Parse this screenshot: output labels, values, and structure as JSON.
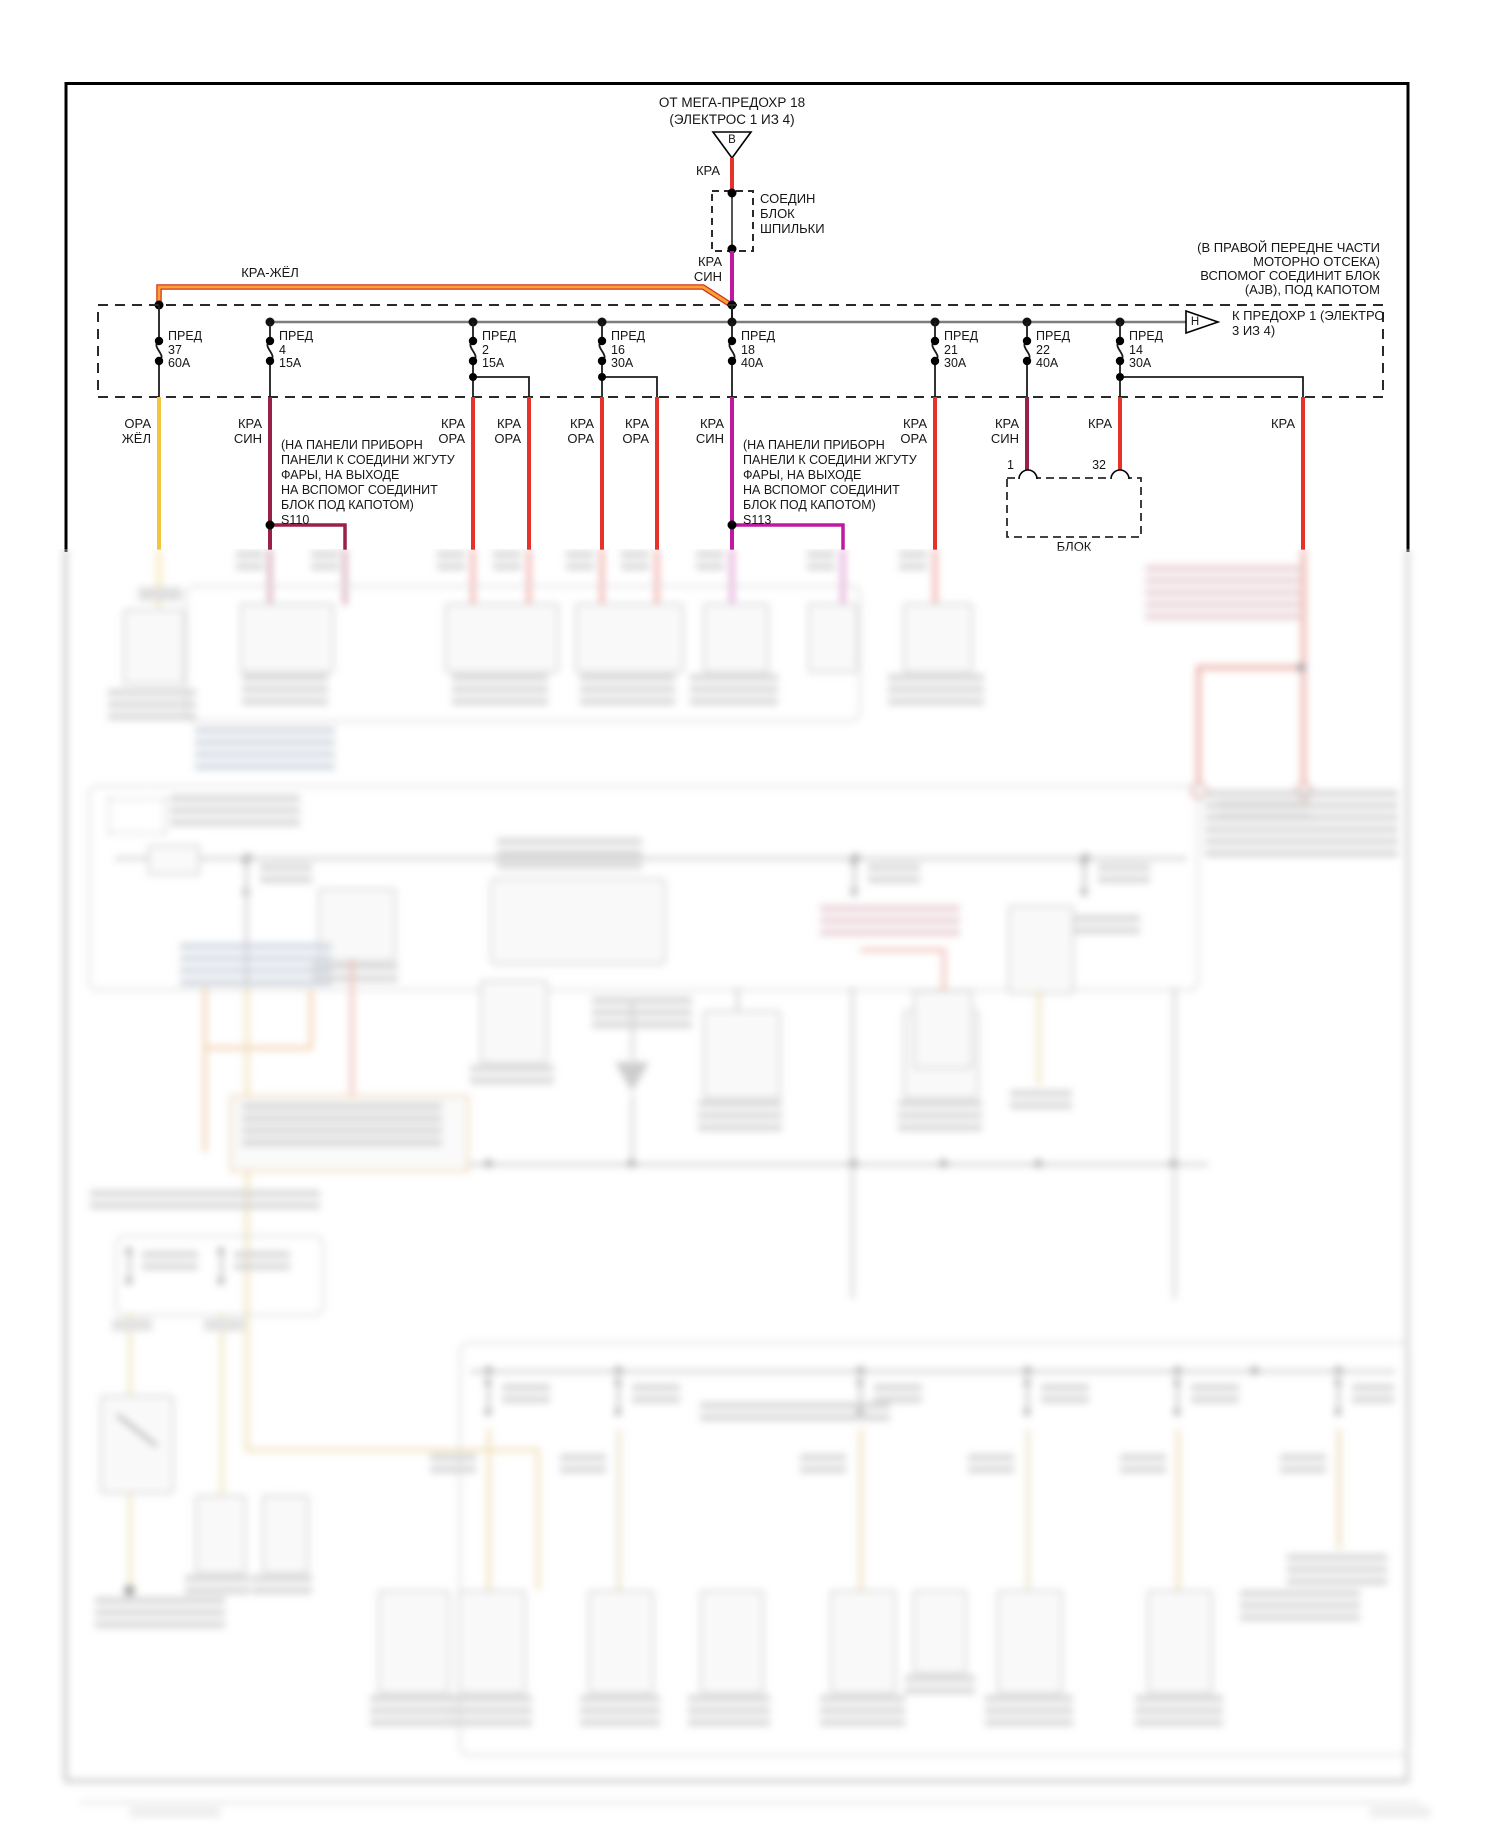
{
  "palette": {
    "red_wire": "#e63329",
    "yellow_wire": "#f2c63c",
    "maroon_wire": "#97214a",
    "magenta_wire": "#c018a0",
    "orange_wire": "#f09a25",
    "orange_wire_edge": "#d93025",
    "bus_gray": "#7d7d7d",
    "ink": "#161616"
  },
  "header": {
    "source_line1": "ОТ МЕГА-ПРЕДОХР 18",
    "source_line2": "(ЭЛЕКТРОС 1 ИЗ 4)",
    "source_connector_letter": "B",
    "source_wire_label": "КРА",
    "splice_block_line1": "СОЕДИН",
    "splice_block_line2": "БЛОК",
    "splice_block_line3": "ШПИЛЬКИ",
    "feed_wire_line1": "КРА",
    "feed_wire_line2": "СИН",
    "jumper_wire_label": "КРА-ЖЁЛ",
    "location_note_line1": "(В ПРАВОЙ ПЕРЕДНЕ ЧАСТИ",
    "location_note_line2": "МОТОРНО ОТСЕКА)",
    "location_note_line3": "ВСПОМОГ СОЕДИНИТ БЛОК",
    "location_note_line4": "(AJB), ПОД КАПОТОМ"
  },
  "fuse_box": {
    "fuses": [
      {
        "label": "ПРЕД",
        "number": "37",
        "amps": "60A"
      },
      {
        "label": "ПРЕД",
        "number": "4",
        "amps": "15A"
      },
      {
        "label": "ПРЕД",
        "number": "2",
        "amps": "15A"
      },
      {
        "label": "ПРЕД",
        "number": "16",
        "amps": "30A"
      },
      {
        "label": "ПРЕД",
        "number": "18",
        "amps": "40A"
      },
      {
        "label": "ПРЕД",
        "number": "21",
        "amps": "30A"
      },
      {
        "label": "ПРЕД",
        "number": "22",
        "amps": "40A"
      },
      {
        "label": "ПРЕД",
        "number": "14",
        "amps": "30A"
      }
    ],
    "exit_connector_letter": "H",
    "exit_label_line1": "К ПРЕДОХР 1 (ЭЛЕКТРО",
    "exit_label_line2": "3 ИЗ 4)"
  },
  "wire_labels": [
    {
      "line1": "ОРА",
      "line2": "ЖЁЛ"
    },
    {
      "line1": "КРА",
      "line2": "СИН"
    },
    {
      "line1": "КРА",
      "line2": "ОРА"
    },
    {
      "line1": "КРА",
      "line2": "ОРА"
    },
    {
      "line1": "КРА",
      "line2": "ОРА"
    },
    {
      "line1": "КРА",
      "line2": "ОРА"
    },
    {
      "line1": "КРА",
      "line2": "СИН"
    },
    {
      "line1": "КРА",
      "line2": "ОРА"
    },
    {
      "line1": "КРА",
      "line2": "СИН"
    },
    {
      "line1": "КРА",
      "line2": ""
    },
    {
      "line1": "КРА",
      "line2": ""
    }
  ],
  "splice_note_s110": {
    "line1": "(НА ПАНЕЛИ ПРИБОРН",
    "line2": "ПАНЕЛИ К СОЕДИНИ ЖГУТУ",
    "line3": "ФАРЫ, НА ВЫХОДЕ",
    "line4": "НА ВСПОМОГ СОЕДИНИТ",
    "line5": "БЛОК ПОД КАПОТОМ)",
    "splice_id": "S110"
  },
  "splice_note_s113": {
    "line1": "(НА ПАНЕЛИ ПРИБОРН",
    "line2": "ПАНЕЛИ К СОЕДИНИ ЖГУТУ",
    "line3": "ФАРЫ, НА ВЫХОДЕ",
    "line4": "НА ВСПОМОГ СОЕДИНИТ",
    "line5": "БЛОК ПОД КАПОТОМ)",
    "splice_id": "S113"
  },
  "block_connector": {
    "pin_left": "1",
    "pin_right": "32",
    "label": "БЛОК"
  }
}
